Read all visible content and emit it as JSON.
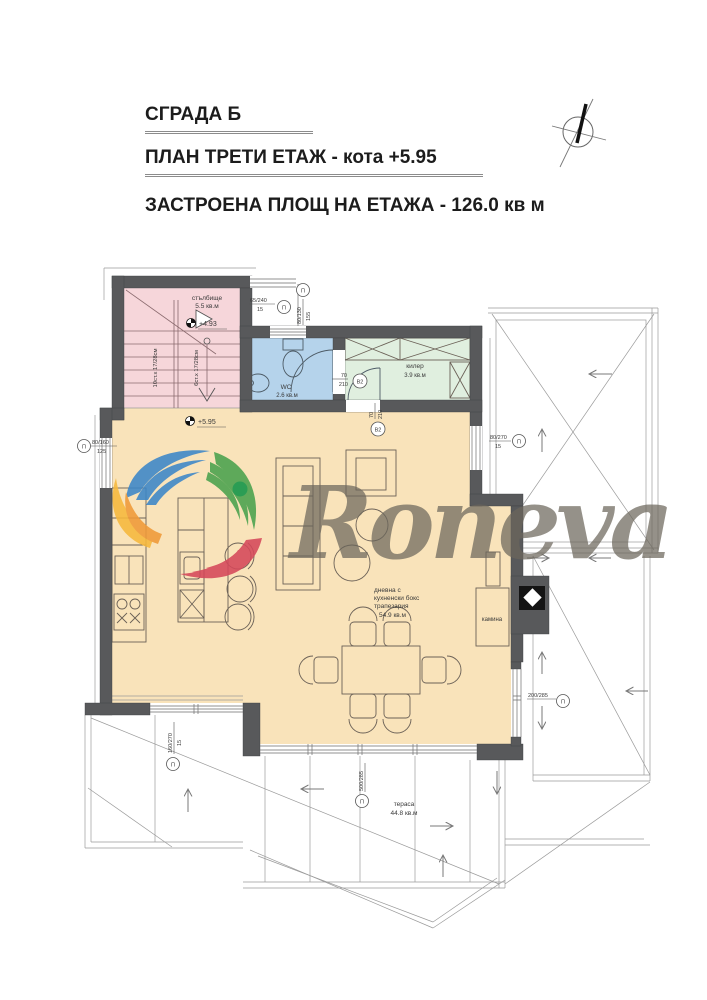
{
  "header": {
    "building_title": "СГРАДА Б",
    "plan_title": "ПЛАН ТРЕТИ ЕТАЖ - кота +5.95",
    "area_title": "ЗАСТРОЕНА ПЛОЩ НА ЕТАЖА - 126.0 кв м"
  },
  "watermark": {
    "text": "Roneva"
  },
  "rooms": {
    "stair": {
      "name": "стълбище",
      "area": "5.5 кв.м"
    },
    "wc": {
      "name": "WC",
      "area": "2.6 кв.м"
    },
    "pantry": {
      "name": "килер",
      "area": "3.9 кв.м"
    },
    "living": {
      "line1": "дневна с",
      "line2": "кухненски бокс",
      "line3": "трапезария",
      "area": "54.9 кв.м"
    },
    "terrace": {
      "name": "тераса",
      "area": "44.8 кв.м"
    },
    "fireplace": {
      "name": "камина"
    }
  },
  "levels": {
    "stair_mid": "+4.93",
    "floor": "+5.95"
  },
  "stairs": {
    "flight_down": "10ст.х 17/28см",
    "flight_up": "6ст.х 17/28см"
  },
  "dims": {
    "win_top": {
      "size": "65/240",
      "sub": "15",
      "sym": "П"
    },
    "win_wc": {
      "size": "80/130",
      "sub": "155",
      "sym": "П"
    },
    "win_left": {
      "size": "80/160",
      "sub": "125",
      "sym": "П"
    },
    "win_right": {
      "size": "80/270",
      "sub": "15",
      "sym": "П"
    },
    "door_wc": {
      "w": "70",
      "h": "210",
      "sym": "В2"
    },
    "door_pantry": {
      "w": "70",
      "h": "210",
      "sym": "В2"
    },
    "win_se": {
      "size": "200/285",
      "sym": "П"
    },
    "win_south": {
      "size": "500/285",
      "sym": "П"
    },
    "win_sw": {
      "size": "160/270",
      "sub": "15",
      "sym": "П"
    }
  },
  "colors": {
    "wall": "#58595b",
    "stair": "#f6d6da",
    "wc": "#b5d3eb",
    "pantry": "#e0efdf",
    "living": "#f9e3ba",
    "logo_blue": "#3c86c8",
    "logo_green": "#49a24d",
    "logo_dark_green": "#0f9447",
    "logo_yellow": "#f6b83c",
    "logo_orange": "#ef9a38",
    "logo_red": "#d5485a",
    "logo_text": "#6b665c"
  }
}
